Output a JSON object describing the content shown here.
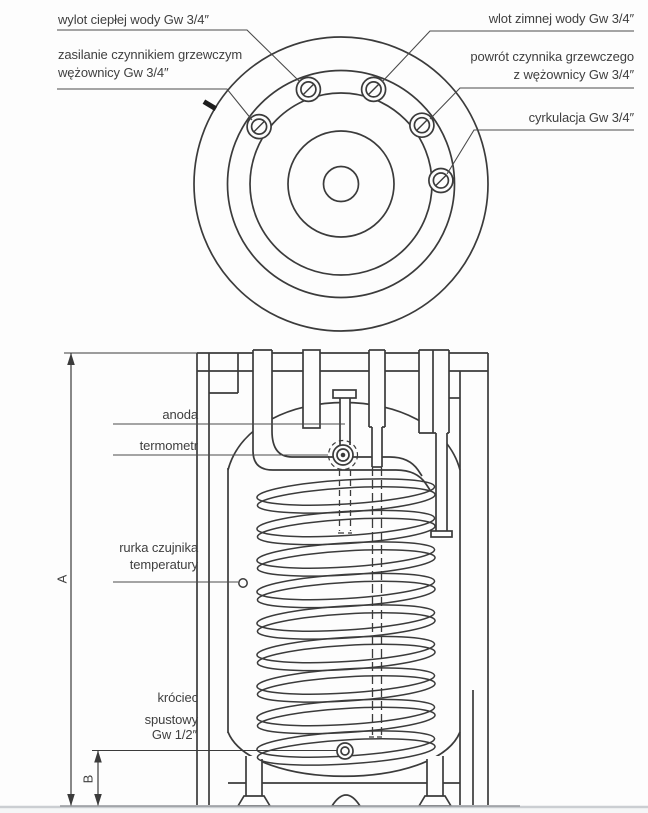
{
  "top_view": {
    "hot_water_outlet": "wylot ciepłej wody Gw 3/4″",
    "coil_supply_line1": "zasilanie czynnikiem grzewczym",
    "coil_supply_line2": "wężownicy Gw 3/4″",
    "cold_water_inlet": "wlot zimnej wody Gw 3/4″",
    "coil_return_line1": "powrót czynnika grzewczego",
    "coil_return_line2": "z wężownicy Gw 3/4″",
    "circulation": "cyrkulacja Gw 3/4″"
  },
  "side_view": {
    "anode": "anoda",
    "thermometer": "termometr",
    "sensor_tube_line1": "rurka czujnika",
    "sensor_tube_line2": "temperatury",
    "drain_line1": "króciec",
    "drain_line2": "spustowy",
    "drain_line3": "Gw 1/2″",
    "dim_height": "A",
    "dim_drain_height": "B"
  },
  "colors": {
    "line": "#3b3b3b",
    "text": "#3f3f3f",
    "ground_dark": "#94979b",
    "ground_light": "#cbced2",
    "background": "#fdfdfd"
  }
}
